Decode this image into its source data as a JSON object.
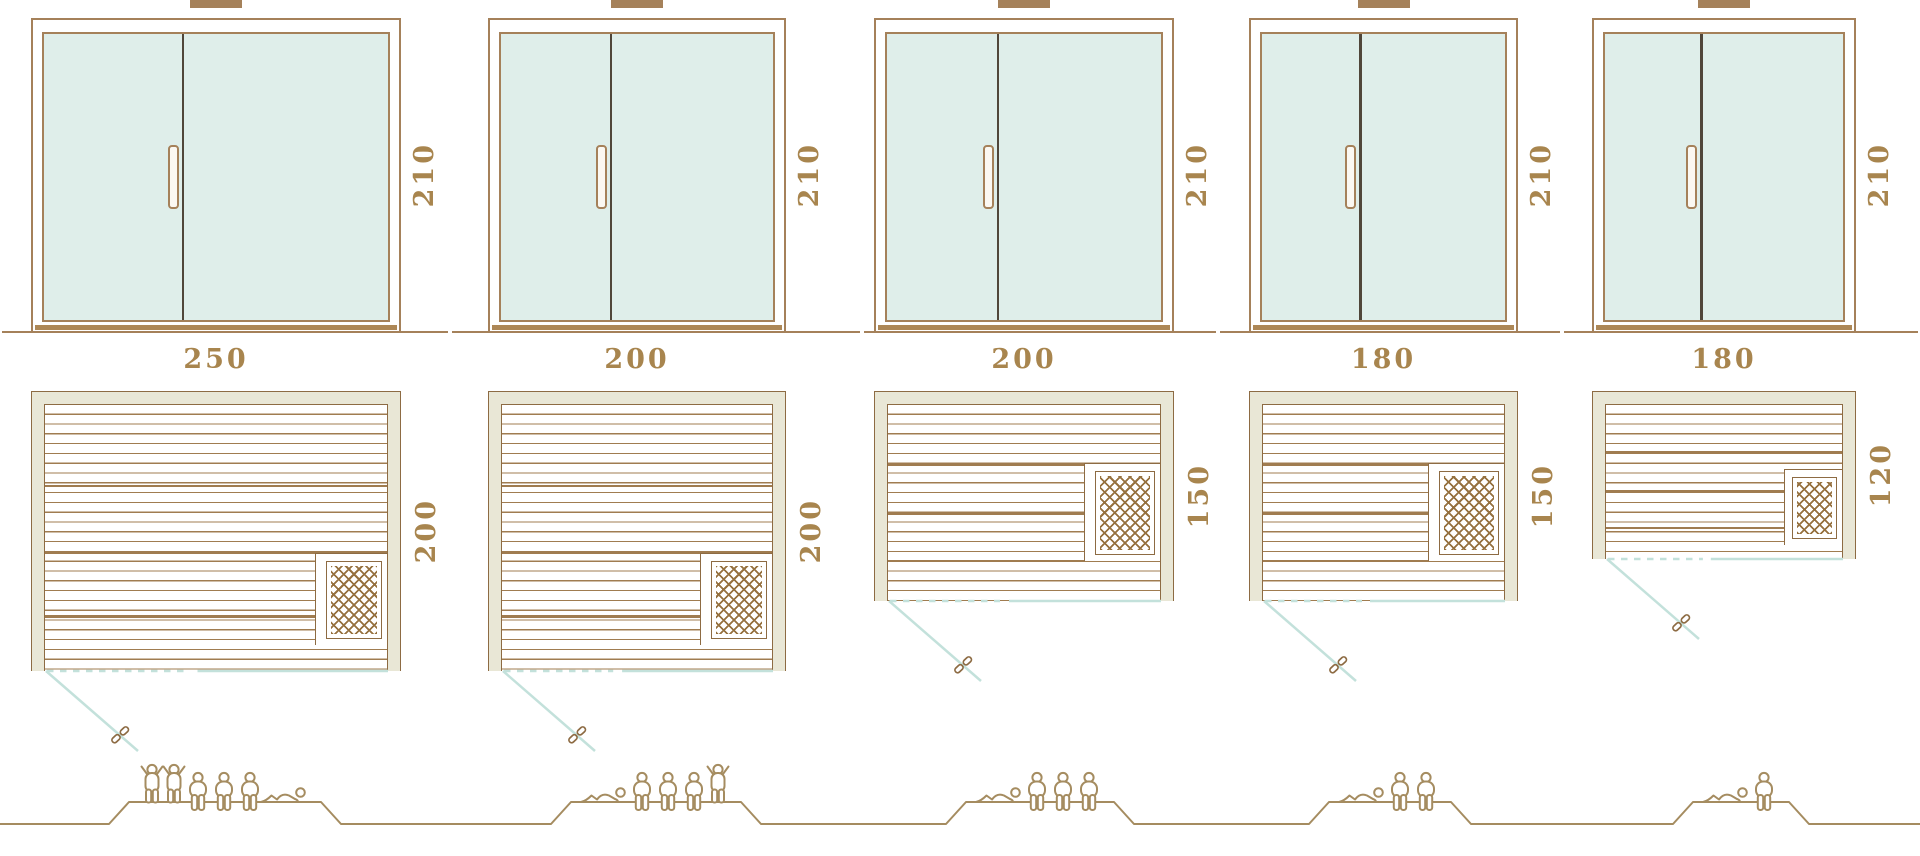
{
  "diagram": {
    "kind": "sauna-size-comparison",
    "rows": [
      "door-front-elevation",
      "floor-plan",
      "capacity-figures"
    ]
  },
  "colors": {
    "outline_brown": "#8d6b43",
    "frame_tan": "#a5815a",
    "glass_mint": "#dfeeea",
    "wall_beige": "#e9e7d6",
    "plank_brown": "#a07c50",
    "label_gold": "#a8854e",
    "glass_line_teal": "#c3e1db",
    "figure_tan": "#a58c60"
  },
  "units": [
    {
      "door_height_cm": "210",
      "width_cm": "250",
      "depth_cm": "200",
      "capacity": 6,
      "capacity_figures": [
        "standing",
        "standing",
        "sitting",
        "sitting",
        "sitting",
        "lying"
      ]
    },
    {
      "door_height_cm": "210",
      "width_cm": "200",
      "depth_cm": "200",
      "capacity": 5,
      "capacity_figures": [
        "lying",
        "sitting",
        "sitting",
        "sitting",
        "standing"
      ]
    },
    {
      "door_height_cm": "210",
      "width_cm": "200",
      "depth_cm": "150",
      "capacity": 4,
      "capacity_figures": [
        "lying",
        "sitting",
        "sitting",
        "sitting"
      ]
    },
    {
      "door_height_cm": "210",
      "width_cm": "180",
      "depth_cm": "150",
      "capacity": 3,
      "capacity_figures": [
        "lying",
        "sitting",
        "sitting"
      ]
    },
    {
      "door_height_cm": "210",
      "width_cm": "180",
      "depth_cm": "120",
      "capacity": 2,
      "capacity_figures": [
        "lying",
        "sitting"
      ]
    }
  ]
}
